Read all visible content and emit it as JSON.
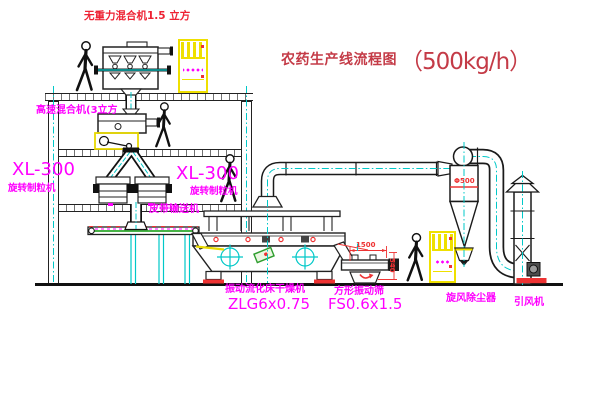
{
  "title": {
    "name": "农药生产线流程图",
    "capacity": "（500kg/h）"
  },
  "labels": {
    "gravity_mixer": "无重力混合机1.5 立方",
    "high_speed_mixer": "高速混合机(3立方",
    "granulator_model_left": "XL-300",
    "granulator_name_left": "旋转制粒机",
    "granulator_model_right": "XL-300",
    "granulator_name_right": "旋转制粒机",
    "belt_conveyor": "皮带输送机",
    "dryer_name": "振动流化床干燥机",
    "dryer_model": "ZLG6x0.75",
    "sieve_name": "方形振动筛",
    "sieve_model": "FS0.6x1.5",
    "cyclone_name": "旋风除尘器",
    "fan_name": "引风机"
  },
  "dimensions": {
    "sieve_length": "1500",
    "sieve_height": "540",
    "cyclone_diameter": "Φ500"
  },
  "colors": {
    "label_magenta": "#ff00ff",
    "title_red": "#c43b47",
    "annotation_red": "#ee2233",
    "dimension_red": "#ee3333",
    "centerline_cyan": "#00c8c8",
    "cabinet_yellow": "#efe000",
    "conveyor_green": "#0a9a0a",
    "linework_black": "#1a1a1a",
    "background": "#ffffff"
  }
}
